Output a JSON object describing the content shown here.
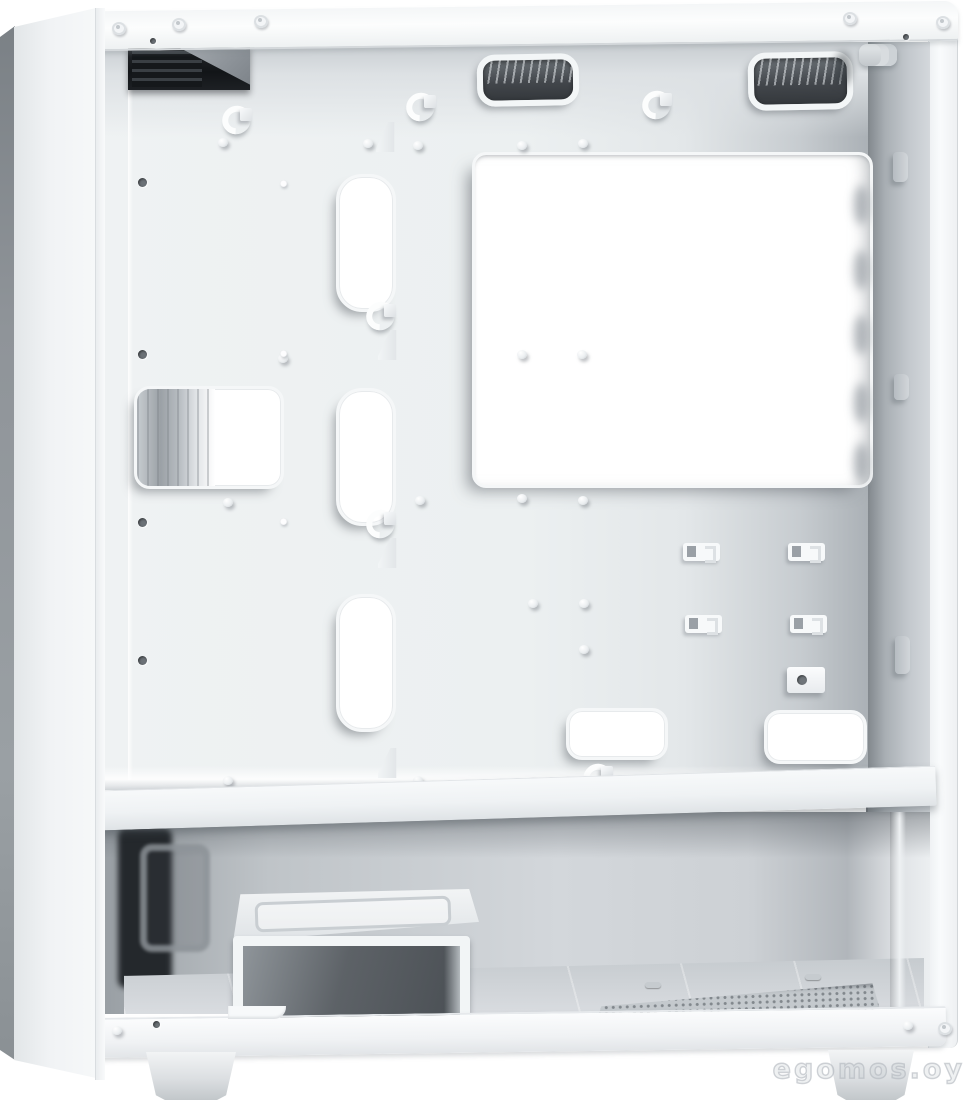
{
  "scene": {
    "title": "White mid-tower PC case, left side panel removed, interior side view",
    "watermark": "egomos.oy"
  },
  "palette": {
    "background": "#ffffff",
    "front_panel_face": "#f1f3f5",
    "front_panel_edge": "#8f9499",
    "frame_white": "#fafbfc",
    "motherboard_tray": "#ecf0f1",
    "tray_rear_shadow": "#abb1b6",
    "vent_mesh_dark": "#43474c",
    "io_module_dark": "#15181b",
    "cutout_interior": "#ffffff",
    "psu_compartment": "#c3c8cc",
    "drive_cage_interior": "#5d6267",
    "floor_vent": "#c4c9cd",
    "watermark_gray": "#c5cbd0"
  },
  "parts": {
    "front_panel": "front-panel",
    "top_rail": "top-frame-rail",
    "rear_frame": "rear-frame-edge",
    "io_module": "front-io-module",
    "top_vent_openings": "top-cable-vent-openings",
    "cpu_cutout": "cpu-cooler-backplate-cutout",
    "front_cutout": "front-cable-cutout-with-fan",
    "cable_slots": "vertical-cable-routing-slots",
    "bottom_grommets": "bottom-cable-pass-throughs",
    "ssd_clips": "ssd-mount-clips",
    "gpu_screw_block": "screw-block",
    "psu_shroud": "psu-divider-shelf",
    "drive_cage": "hdd-drive-cage",
    "floor_vent": "perforated-psu-floor-vent",
    "case_feet": "case-feet",
    "standoff_screws": "motherboard-standoff-screws",
    "cable_anchors": "cable-tie-anchors"
  }
}
